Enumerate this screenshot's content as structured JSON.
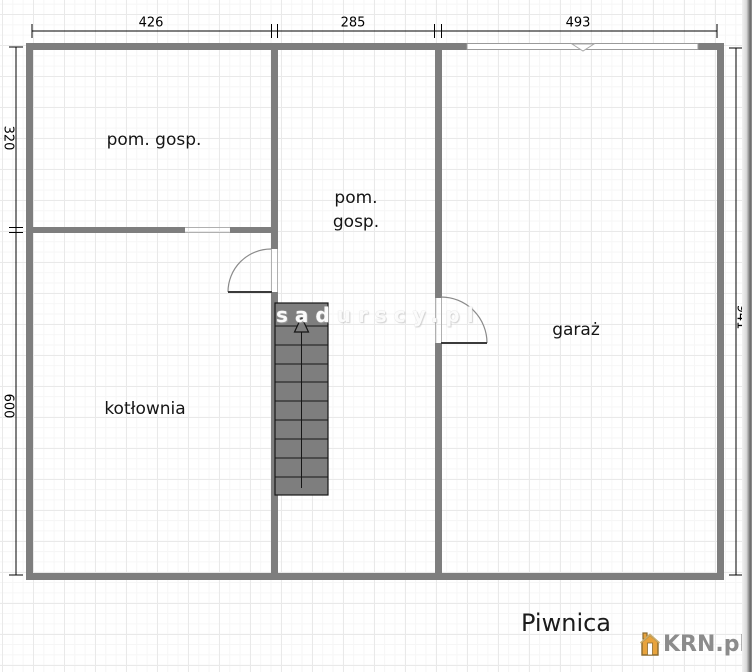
{
  "floor": {
    "title": "Piwnica"
  },
  "rooms": [
    {
      "label": "pom. gosp."
    },
    {
      "line1": "pom.",
      "line2": "gosp."
    },
    {
      "label": "kotłownia"
    },
    {
      "label": "garaż"
    }
  ],
  "dimensions": {
    "top": [
      "426",
      "285",
      "493"
    ],
    "left": [
      "320",
      "600"
    ],
    "right": [
      "941"
    ]
  },
  "watermark": {
    "text": "sadurscy.pl"
  },
  "branding": {
    "logo_text": "KRN.pl"
  },
  "colors": {
    "wall": "#7e7e7e",
    "dimension_line": "#000000",
    "stairs_fill": "#7e7e7e",
    "logo_text": "#8c8c8c",
    "logo_house": "#e8a33c"
  }
}
